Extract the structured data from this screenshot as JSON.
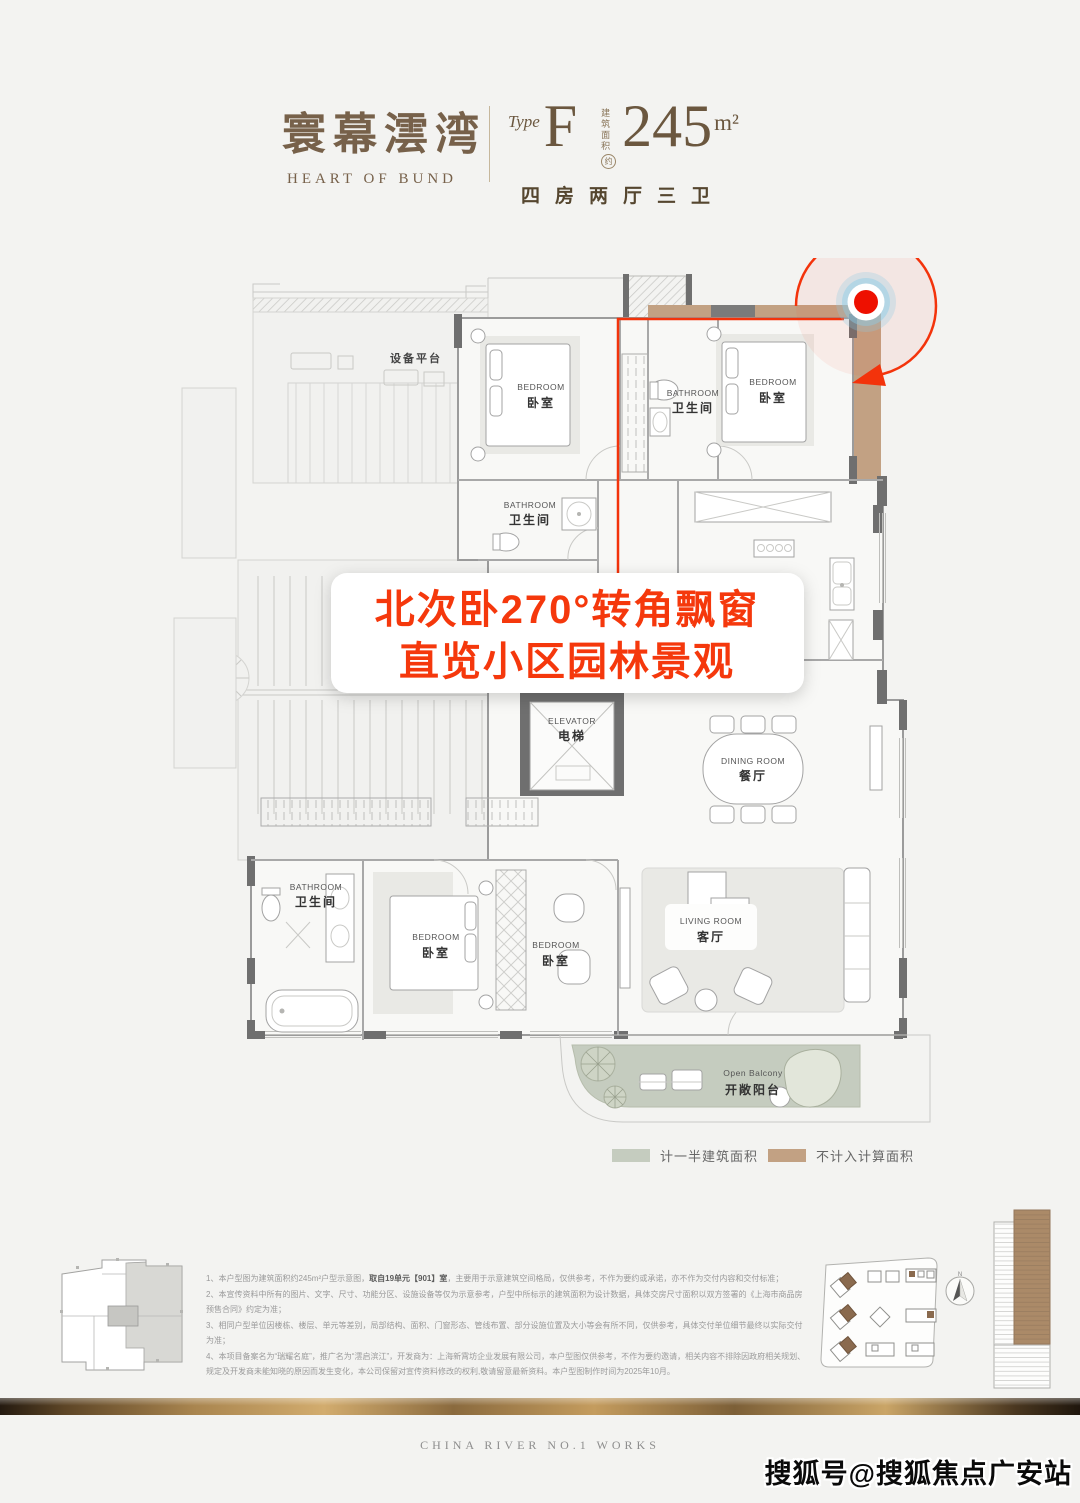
{
  "header": {
    "logo_cn": "寰幕澐湾",
    "logo_en": "HEART OF BUND",
    "type_prefix": "Type",
    "type_letter": "F",
    "area_label_1": "建筑",
    "area_label_2": "面积",
    "area_approx": "约",
    "area_value": "245",
    "area_unit": "m²",
    "layout_desc": "四房两厅三卫"
  },
  "floorplan": {
    "annotation": {
      "line1": "北次卧270°转角飘窗",
      "line2": "直览小区园林景观"
    },
    "rooms": {
      "equipment": {
        "cn": "设备平台"
      },
      "bedroom_nw": {
        "en": "BEDROOM",
        "cn": "卧室"
      },
      "bedroom_ne": {
        "en": "BEDROOM",
        "cn": "卧室"
      },
      "bath_n": {
        "en": "BATHROOM",
        "cn": "卫生间"
      },
      "bath_m": {
        "en": "BATHROOM",
        "cn": "卫生间"
      },
      "elevator": {
        "en": "ELEVATOR",
        "cn": "电梯"
      },
      "dining": {
        "en": "DINING ROOM",
        "cn": "餐厅"
      },
      "living": {
        "en": "LIVING ROOM",
        "cn": "客厅"
      },
      "bedroom_master": {
        "en": "BEDROOM",
        "cn": "卧室"
      },
      "bedroom_south": {
        "en": "BEDROOM",
        "cn": "卧室"
      },
      "bath_sw": {
        "en": "BATHROOM",
        "cn": "卫生间"
      },
      "balcony": {
        "en": "Open Balcony",
        "cn": "开敞阳台"
      }
    },
    "colors": {
      "accent_red": "#F3330B",
      "bay_window_tan": "#C2A183",
      "balcony_green": "#C5CCBF",
      "wall_gray": "#6F6F6F"
    }
  },
  "legend": {
    "half_area_label": "计一半建筑面积",
    "half_area_color": "#C5CCBF",
    "excluded_label": "不计入计算面积",
    "excluded_color": "#C2A183"
  },
  "disclaimer": {
    "l1_pre": "1、本户型图为建筑面积约245m²户型示意图，",
    "l1_bold": "取自19单元【901】室",
    "l1_post": "，主要用于示意建筑空间格局，仅供参考，不作为要约或承诺，亦不作为交付内容和交付标准；",
    "l2": "2、本宣传资料中所有的图片、文字、尺寸、功能分区、设施设备等仅为示意参考，户型中所标示的建筑面积为设计数据，具体交房尺寸面积以双方签署的《上海市商品房预售合同》约定为准；",
    "l3": "3、相同户型单位因楼栋、楼层、单元等差别，局部结构、面积、门窗形态、管线布置、部分设施位置及大小等会有所不同，仅供参考，具体交付单位细节最终以实际交付为准；",
    "l4": "4、本项目备案名为“瑞耀名庭”，推广名为“澐启滨江”，开发商为：上海新霄坊企业发展有限公司，本户型图仅供参考，不作为要约邀请，相关内容不排除因政府相关规划、规定及开发商未能知晓的原因而发生变化，本公司保留对宣传资料修改的权利,敬请留意最新资料。本户型图制作时间为2025年10月。"
  },
  "bottom": {
    "north_label": "N"
  },
  "footer": {
    "series_en": "CHINA RIVER NO.1 WORKS",
    "watermark": "搜狐号@搜狐焦点广安站"
  }
}
